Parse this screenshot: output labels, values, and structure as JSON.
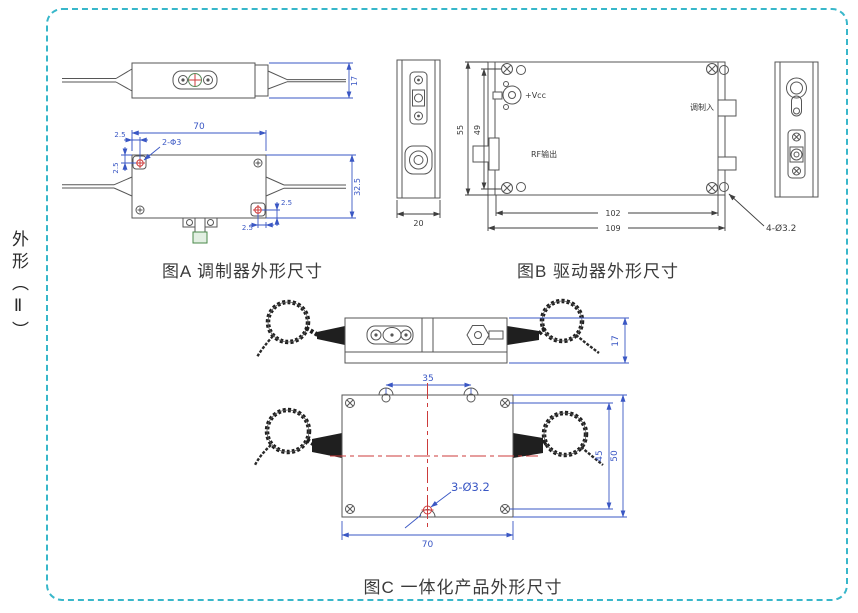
{
  "page": {
    "side_label": "外形（Ⅱ）"
  },
  "colors": {
    "border_teal": "#38b7ca",
    "dimension_blue": "#3a57c4",
    "centerline_red": "#cc3b3b",
    "outline_gray": "#565656"
  },
  "figure_a": {
    "caption": "图A 调制器外形尺寸",
    "dims": {
      "body_height": "17",
      "body_length": "70",
      "hole_offset_x": "2.5",
      "hole_offset_y": "2.5",
      "hole_callout": "2-Φ3",
      "body_width": "32.5",
      "hole_offset_y2": "2.5",
      "hole_offset_x2": "2.5"
    }
  },
  "figure_b": {
    "caption": "图B 驱动器外形尺寸",
    "labels": {
      "vcc": "+Vcc",
      "rf_output": "RF输出",
      "mod_input": "调制入"
    },
    "dims": {
      "height_outer": "55",
      "hole_spacing_v": "49",
      "hole_spacing_h": "102",
      "length": "109",
      "depth": "20",
      "hole_callout": "4-Ø3.2"
    }
  },
  "figure_c": {
    "caption": "图C  一体化产品外形尺寸",
    "dims": {
      "body_height": "17",
      "ear_spacing": "35",
      "hole_spacing_v": "45",
      "body_width": "50",
      "body_length": "70",
      "hole_callout": "3-Ø3.2"
    }
  }
}
